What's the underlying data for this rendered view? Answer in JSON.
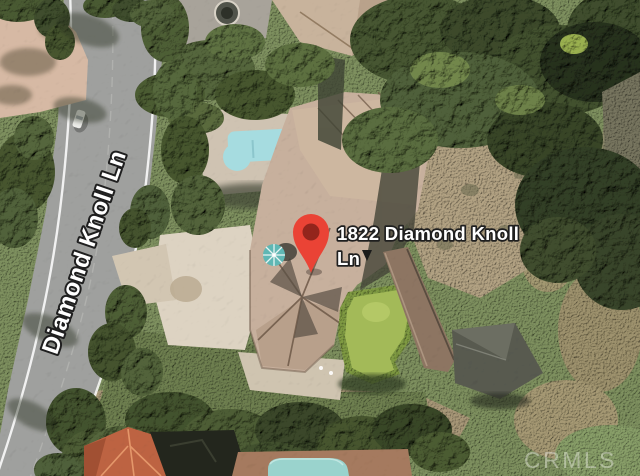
{
  "map": {
    "street_label": "Diamond Knoll Ln",
    "marker": {
      "label_line1": "1822 Diamond Knoll",
      "label_line2": "Ln"
    },
    "watermark": "CRMLS",
    "colors": {
      "pin": "#EA4335",
      "pin_inner": "#93251C",
      "pool": "#A6DCE0",
      "bottom_pool": "#9AD3CD",
      "roof": "#C7B09D",
      "neighbor_roof": "#C8B39C",
      "road": "#9FA09E",
      "driveway": "#DDD3C2",
      "pink_patio": "#D6B9A4",
      "putting_green": "#A3BA58",
      "trees_dark": "#3E4F30",
      "hillside": "#7E905F",
      "dirt": "#B2A283",
      "label_fill": "#FFFFFF",
      "label_outline": "#1F1F1F"
    }
  }
}
